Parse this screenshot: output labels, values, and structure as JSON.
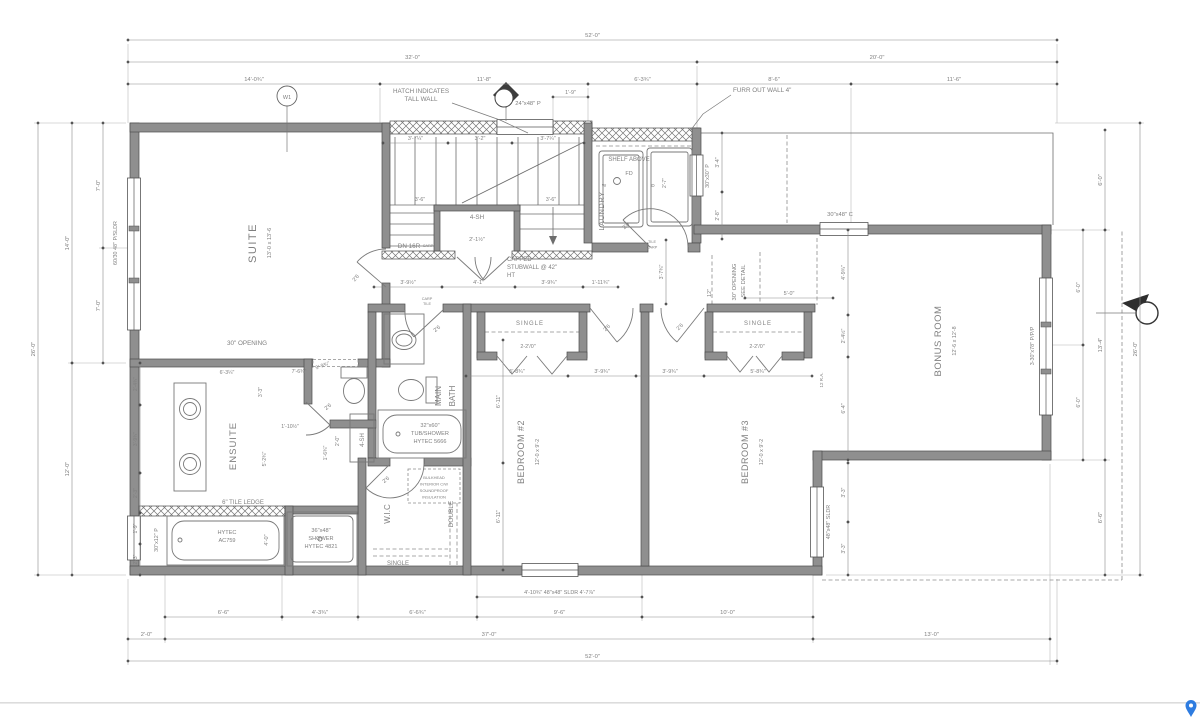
{
  "meta": {
    "description": "Residential floor plan drawing - suite, ensuite, main bath, laundry, bedrooms 2 and 3, bonus room"
  },
  "colors": {
    "wall_fill": "#8f8f8f",
    "line": "#6d6d6d",
    "text": "#7f7f7f",
    "pin_blue": "#2e7ce0"
  },
  "plan": {
    "labels": [
      {
        "n": "room-label-suite",
        "t": "SUITE",
        "x": 256,
        "y": 243,
        "r": -90,
        "s": 11,
        "ls": 1.5
      },
      {
        "n": "room-size-suite",
        "t": "13'-0 x 13'-6",
        "x": 271,
        "y": 243,
        "r": -90,
        "s": 5.6
      },
      {
        "n": "room-label-ensuite",
        "t": "ENSUITE",
        "x": 236,
        "y": 446,
        "r": -90,
        "s": 9.5,
        "ls": 1
      },
      {
        "n": "room-label-main-bath-1",
        "t": "MAIN",
        "x": 441,
        "y": 396,
        "r": -90,
        "s": 8
      },
      {
        "n": "room-label-main-bath-2",
        "t": "BATH",
        "x": 455,
        "y": 396,
        "r": -90,
        "s": 8
      },
      {
        "n": "room-label-wic",
        "t": "W.I.C",
        "x": 390,
        "y": 514,
        "r": -90,
        "s": 8
      },
      {
        "n": "room-label-bedroom2",
        "t": "BEDROOM #2",
        "x": 524,
        "y": 452,
        "r": -90,
        "s": 9,
        "ls": 0.5
      },
      {
        "n": "room-size-bedroom2",
        "t": "12'-0 x 9'-2",
        "x": 539,
        "y": 452,
        "r": -90,
        "s": 5.4
      },
      {
        "n": "room-label-bedroom3",
        "t": "BEDROOM #3",
        "x": 748,
        "y": 452,
        "r": -90,
        "s": 9,
        "ls": 0.5
      },
      {
        "n": "room-size-bedroom3",
        "t": "12'-0 x 9'-2",
        "x": 763,
        "y": 452,
        "r": -90,
        "s": 5.4
      },
      {
        "n": "room-label-bonus",
        "t": "BONUS ROOM",
        "x": 941,
        "y": 341,
        "r": -90,
        "s": 9.5,
        "ls": 0.5
      },
      {
        "n": "room-size-bonus",
        "t": "12'-6 x 12'-8",
        "x": 956,
        "y": 341,
        "r": -90,
        "s": 5.4
      },
      {
        "n": "room-label-laundry",
        "t": "LAUNDRY",
        "x": 604,
        "y": 211,
        "r": -90,
        "s": 7.5,
        "ls": 0.5
      },
      {
        "n": "closet-label-double",
        "t": "DOUBLE",
        "x": 453,
        "y": 514,
        "r": -90,
        "s": 6.5
      },
      {
        "n": "closet-label-single-wic",
        "t": "SINGLE",
        "x": 398,
        "y": 565,
        "s": 6
      },
      {
        "n": "closet-label-single-bed2",
        "t": "SINGLE",
        "x": 530,
        "y": 325,
        "s": 6,
        "ls": 1
      },
      {
        "n": "closet-label-single-bed3",
        "t": "SINGLE",
        "x": 758,
        "y": 325,
        "s": 6,
        "ls": 1
      },
      {
        "n": "note-hatch-1",
        "t": "HATCH INDICATES",
        "x": 421,
        "y": 93,
        "s": 6.3
      },
      {
        "n": "note-hatch-2",
        "t": "TALL WALL",
        "x": 421,
        "y": 101,
        "s": 6.3
      },
      {
        "n": "note-furr",
        "t": "FURR OUT WALL 4\"",
        "x": 733,
        "y": 92,
        "s": 6.3,
        "a": "start"
      },
      {
        "n": "note-shelf-above",
        "t": "SHELF ABOVE",
        "x": 629,
        "y": 161,
        "s": 6
      },
      {
        "n": "label-floor-drain",
        "t": "FD",
        "x": 629,
        "y": 175,
        "s": 5.5
      },
      {
        "n": "label-washer",
        "t": "W",
        "x": 604,
        "y": 187,
        "s": 4.5
      },
      {
        "n": "label-dryer",
        "t": "D",
        "x": 653,
        "y": 187,
        "s": 4.5
      },
      {
        "n": "note-capped-1",
        "t": "CAPPED",
        "x": 507,
        "y": 261,
        "s": 6,
        "a": "start"
      },
      {
        "n": "note-capped-2",
        "t": "STUBWALL @ 42\"",
        "x": 507,
        "y": 269,
        "s": 6,
        "a": "start"
      },
      {
        "n": "note-capped-3",
        "t": "HT",
        "x": 507,
        "y": 277,
        "s": 6,
        "a": "start"
      },
      {
        "n": "note-30-opening",
        "t": "30\" OPENING",
        "x": 247,
        "y": 345,
        "s": 6.3
      },
      {
        "n": "note-tile-ledge",
        "t": "6\" TILE LEDGE",
        "x": 243,
        "y": 504,
        "s": 6
      },
      {
        "n": "fixture-tub-label-1",
        "t": "HYTEC",
        "x": 227,
        "y": 534,
        "s": 5.6
      },
      {
        "n": "fixture-tub-label-2",
        "t": "AC759",
        "x": 227,
        "y": 542,
        "s": 5.6
      },
      {
        "n": "fixture-shower-label-1",
        "t": "36\"x48\"",
        "x": 321,
        "y": 532,
        "s": 5.6
      },
      {
        "n": "fixture-shower-label-2",
        "t": "SHOWER",
        "x": 321,
        "y": 540,
        "s": 5.6
      },
      {
        "n": "fixture-shower-label-3",
        "t": "HYTEC 4821",
        "x": 321,
        "y": 548,
        "s": 5.6
      },
      {
        "n": "fixture-tubshower-label-1",
        "t": "32\"x60\"",
        "x": 430,
        "y": 427,
        "s": 5.6
      },
      {
        "n": "fixture-tubshower-label-2",
        "t": "TUB/SHOWER",
        "x": 430,
        "y": 435,
        "s": 5.6
      },
      {
        "n": "fixture-tubshower-label-3",
        "t": "HYTEC 5666",
        "x": 430,
        "y": 443,
        "s": 5.6
      },
      {
        "n": "label-4sh-stair",
        "t": "4-SH",
        "x": 477,
        "y": 219,
        "s": 6.3
      },
      {
        "n": "dim-closet-depth",
        "t": "2'-1½\"",
        "x": 477,
        "y": 241,
        "s": 5.6
      },
      {
        "n": "label-4sh-ensuite",
        "t": "4-SH",
        "x": 364,
        "y": 440,
        "r": -90,
        "s": 6
      },
      {
        "n": "label-dn-16r",
        "t": "DN 16R",
        "x": 409,
        "y": 248,
        "s": 6.3
      },
      {
        "n": "note-bonus-opening-1",
        "t": "30\" OPENING",
        "x": 736,
        "y": 282,
        "r": -90,
        "s": 5.8
      },
      {
        "n": "note-bonus-opening-2",
        "t": "-SEE DETAIL",
        "x": 745,
        "y": 282,
        "r": -90,
        "s": 5.8
      },
      {
        "n": "window-label-suite",
        "t": "60/30 48\" P/SLDR",
        "x": 117,
        "y": 243,
        "r": -90,
        "s": 5.4
      },
      {
        "n": "window-label-tub",
        "t": "30\"x12\" P",
        "x": 158,
        "y": 540,
        "r": -90,
        "s": 5.4
      },
      {
        "n": "window-label-stair",
        "t": "24\"x48\" P",
        "x": 528,
        "y": 105,
        "s": 5.8
      },
      {
        "n": "window-label-laundry",
        "t": "30\"x30\" P",
        "x": 709,
        "y": 176,
        "r": -90,
        "s": 5.4
      },
      {
        "n": "window-label-bonus-top",
        "t": "30\"x48\" C",
        "x": 840,
        "y": 216,
        "s": 5.8
      },
      {
        "n": "window-label-bonus-right",
        "t": "3-30\"x78\" P/P/P",
        "x": 1034,
        "y": 346,
        "r": -90,
        "s": 5.4
      },
      {
        "n": "window-label-bed3",
        "t": "48\"x48\" SLDR",
        "x": 830,
        "y": 522,
        "r": -90,
        "s": 5.4
      },
      {
        "n": "keynote-w1-label",
        "t": "W1",
        "x": 287,
        "y": 99,
        "s": 5.5
      },
      {
        "n": "note-box-line-1",
        "t": "BULKHEAD",
        "x": 434,
        "y": 479,
        "s": 4
      },
      {
        "n": "note-box-line-2",
        "t": "INTERIOR C/W",
        "x": 434,
        "y": 485.5,
        "s": 4
      },
      {
        "n": "note-box-line-3",
        "t": "SOUNDPROOF",
        "x": 434,
        "y": 492,
        "s": 4
      },
      {
        "n": "note-box-line-4",
        "t": "INSULATION",
        "x": 434,
        "y": 498.5,
        "s": 4
      },
      {
        "n": "finish-tile-laundry",
        "t": "TILE",
        "x": 652,
        "y": 243,
        "s": 3.8
      },
      {
        "n": "finish-carp-laundry",
        "t": "CARP",
        "x": 652,
        "y": 248.5,
        "s": 3.8
      },
      {
        "n": "finish-carp-stair",
        "t": "CARP",
        "x": 428,
        "y": 247,
        "s": 3.8
      },
      {
        "n": "finish-carp-bath",
        "t": "CARP",
        "x": 427,
        "y": 300,
        "s": 3.8
      },
      {
        "n": "finish-tile-bath",
        "t": "TILE",
        "x": 427,
        "y": 305,
        "s": 3.8
      },
      {
        "n": "label-return-air",
        "t": "12 R.A.",
        "x": 823,
        "y": 380,
        "r": -90,
        "s": 4.5
      },
      {
        "n": "door-label-suite",
        "t": "2'6",
        "x": 357,
        "y": 279,
        "r": -50,
        "s": 5.4
      },
      {
        "n": "door-label-wc",
        "t": "2'6",
        "x": 329,
        "y": 408,
        "r": -40,
        "s": 5.4
      },
      {
        "n": "door-label-bath",
        "t": "2'6",
        "x": 438,
        "y": 330,
        "r": -40,
        "s": 5.4
      },
      {
        "n": "door-label-wic",
        "t": "2'6",
        "x": 387,
        "y": 481,
        "r": -40,
        "s": 5.4
      },
      {
        "n": "door-label-laundry",
        "t": "2'6",
        "x": 627,
        "y": 227,
        "r": -45,
        "s": 5.4
      },
      {
        "n": "door-label-bed2",
        "t": "2'6",
        "x": 608,
        "y": 329,
        "r": -45,
        "s": 5.4
      },
      {
        "n": "door-label-bed3",
        "t": "2'6",
        "x": 681,
        "y": 328,
        "r": -45,
        "s": 5.4
      },
      {
        "n": "dim-dryer-width",
        "t": "2'-7\"",
        "x": 666,
        "y": 183,
        "r": -90,
        "s": 5
      },
      {
        "n": "closet-doors-bed2",
        "t": "2-2'/0\"",
        "x": 528,
        "y": 348,
        "s": 5.4
      },
      {
        "n": "closet-doors-bed3",
        "t": "2-2'/0\"",
        "x": 757,
        "y": 348,
        "s": 5.4
      },
      {
        "n": "dim-stair-1",
        "t": "3'-6\"",
        "x": 420,
        "y": 201,
        "s": 5.2
      },
      {
        "n": "dim-stair-2",
        "t": "3'-6\"",
        "x": 551,
        "y": 201,
        "s": 5.2
      },
      {
        "n": "dim-ensuite-1",
        "t": "6'-3¼\"",
        "x": 227,
        "y": 374,
        "s": 5.2
      },
      {
        "n": "dim-ensuite-2",
        "t": "3'-3\"",
        "x": 262,
        "y": 392,
        "r": -90,
        "s": 5.2
      },
      {
        "n": "dim-ensuite-3",
        "t": "7'-6¾\"",
        "x": 299,
        "y": 373,
        "s": 5.2
      },
      {
        "n": "dim-ensuite-4",
        "t": "5'-9¾\"",
        "x": 323,
        "y": 367,
        "r": -20,
        "s": 5.2
      },
      {
        "n": "dim-ensuite-5",
        "t": "1'-10½\"",
        "x": 290,
        "y": 428,
        "s": 5.2
      },
      {
        "n": "dim-ensuite-6",
        "t": "5'-2¾\"",
        "x": 266,
        "y": 459,
        "r": -90,
        "s": 5.2
      },
      {
        "n": "dim-ensuite-7",
        "t": "2'-0\"",
        "x": 339,
        "y": 441,
        "r": -90,
        "s": 5.2
      },
      {
        "n": "dim-ensuite-8",
        "t": "1'-6¾\"",
        "x": 327,
        "y": 453,
        "r": -90,
        "s": 5.2
      },
      {
        "n": "dim-tub-length",
        "t": "4'-0\"",
        "x": 268,
        "y": 540,
        "r": -90,
        "s": 5.6
      },
      {
        "n": "dim-opening-12",
        "t": "12\"",
        "x": 711,
        "y": 293,
        "r": -90,
        "s": 5.2
      }
    ],
    "dims": [
      {
        "t": "52'-0\"",
        "x1": 128,
        "y1": 40,
        "x2": 1057,
        "y2": 40
      },
      {
        "t": "32'-0\"",
        "x1": 128,
        "y1": 62,
        "x2": 697,
        "y2": 62
      },
      {
        "t": "20'-0\"",
        "x1": 697,
        "y1": 62,
        "x2": 1057,
        "y2": 62
      },
      {
        "t": "14'-0¾\"",
        "x1": 128,
        "y1": 84,
        "x2": 380,
        "y2": 84
      },
      {
        "t": "11'-8\"",
        "x1": 380,
        "y1": 84,
        "x2": 588,
        "y2": 84
      },
      {
        "t": "6'-3¾\"",
        "x1": 588,
        "y1": 84,
        "x2": 697,
        "y2": 84
      },
      {
        "t": "8'-6\"",
        "x1": 697,
        "y1": 84,
        "x2": 851,
        "y2": 84
      },
      {
        "t": "11'-6\"",
        "x1": 851,
        "y1": 84,
        "x2": 1057,
        "y2": 84
      },
      {
        "t": "1'-9\"",
        "x1": 553,
        "y1": 97,
        "x2": 588,
        "y2": 97,
        "s": 5.4
      },
      {
        "t": "3'-7¼\"",
        "x1": 383,
        "y1": 143,
        "x2": 448,
        "y2": 143,
        "s": 5.4
      },
      {
        "t": "3'-2\"",
        "x1": 448,
        "y1": 143,
        "x2": 512,
        "y2": 143,
        "s": 5.4
      },
      {
        "t": "3'-7¼\"",
        "x1": 512,
        "y1": 143,
        "x2": 584,
        "y2": 143,
        "s": 5.4
      },
      {
        "t": "6'-6\"",
        "x1": 165,
        "y1": 617,
        "x2": 282,
        "y2": 617
      },
      {
        "t": "4'-3¾\"",
        "x1": 282,
        "y1": 617,
        "x2": 358,
        "y2": 617
      },
      {
        "t": "6'-6¾\"",
        "x1": 358,
        "y1": 617,
        "x2": 477,
        "y2": 617
      },
      {
        "t": "9'-6\"",
        "x1": 477,
        "y1": 617,
        "x2": 642,
        "y2": 617
      },
      {
        "t": "10'-0\"",
        "x1": 642,
        "y1": 617,
        "x2": 813,
        "y2": 617
      },
      {
        "t": "4'-10¾\" 48\"x48\" SLDR 4'-7⅞\"",
        "x1": 477,
        "y1": 597,
        "x2": 642,
        "y2": 597,
        "s": 5.4
      },
      {
        "t": "2'-0\"",
        "x1": 128,
        "y1": 639,
        "x2": 165,
        "y2": 639
      },
      {
        "t": "37'-0\"",
        "x1": 165,
        "y1": 639,
        "x2": 813,
        "y2": 639
      },
      {
        "t": "13'-0\"",
        "x1": 813,
        "y1": 639,
        "x2": 1050,
        "y2": 639
      },
      {
        "t": "52'-0\"",
        "x1": 128,
        "y1": 661,
        "x2": 1057,
        "y2": 661
      },
      {
        "t": "26'-0\"",
        "x1": 38,
        "y1": 575,
        "x2": 38,
        "y2": 123
      },
      {
        "t": "14'-0\"",
        "x1": 72,
        "y1": 363,
        "x2": 72,
        "y2": 123
      },
      {
        "t": "12'-0\"",
        "x1": 72,
        "y1": 575,
        "x2": 72,
        "y2": 363
      },
      {
        "t": "7'-0\"",
        "x1": 103,
        "y1": 248,
        "x2": 103,
        "y2": 123
      },
      {
        "t": "7'-0\"",
        "x1": 103,
        "y1": 363,
        "x2": 103,
        "y2": 248
      },
      {
        "t": "2'-4¾\"",
        "x1": 140,
        "y1": 405,
        "x2": 140,
        "y2": 363,
        "s": 5
      },
      {
        "t": "3'-9¾\"",
        "x1": 140,
        "y1": 473,
        "x2": 140,
        "y2": 405,
        "s": 5
      },
      {
        "t": "2'-3\"",
        "x1": 140,
        "y1": 513,
        "x2": 140,
        "y2": 473,
        "s": 5
      },
      {
        "t": "1'-9\"",
        "x1": 140,
        "y1": 544,
        "x2": 140,
        "y2": 513,
        "s": 5
      },
      {
        "t": "2'-3\"",
        "x1": 140,
        "y1": 575,
        "x2": 140,
        "y2": 544,
        "s": 5
      },
      {
        "t": "26'-0\"",
        "x1": 1140,
        "y1": 575,
        "x2": 1140,
        "y2": 123
      },
      {
        "t": "6'-0\"",
        "x1": 1105,
        "y1": 230,
        "x2": 1105,
        "y2": 130
      },
      {
        "t": "13'-4\"",
        "x1": 1105,
        "y1": 460,
        "x2": 1105,
        "y2": 230
      },
      {
        "t": "6'-6\"",
        "x1": 1105,
        "y1": 575,
        "x2": 1105,
        "y2": 460
      },
      {
        "t": "6'-0\"",
        "x1": 1083,
        "y1": 345,
        "x2": 1083,
        "y2": 230,
        "s": 5.2
      },
      {
        "t": "6'-0\"",
        "x1": 1083,
        "y1": 460,
        "x2": 1083,
        "y2": 345,
        "s": 5.2
      },
      {
        "t": "3'-4\"",
        "x1": 722,
        "y1": 192,
        "x2": 722,
        "y2": 133,
        "s": 5.2
      },
      {
        "t": "2'-8\"",
        "x1": 722,
        "y1": 239,
        "x2": 722,
        "y2": 192,
        "s": 5.2
      },
      {
        "t": "4'-9¾\"",
        "x1": 848,
        "y1": 315,
        "x2": 848,
        "y2": 230,
        "s": 5.2
      },
      {
        "t": "2'-4½\"",
        "x1": 848,
        "y1": 357,
        "x2": 848,
        "y2": 315,
        "s": 5.2
      },
      {
        "t": "6'-4\"",
        "x1": 848,
        "y1": 460,
        "x2": 848,
        "y2": 357,
        "s": 5.2
      },
      {
        "t": "3'-3\"",
        "x1": 848,
        "y1": 522,
        "x2": 848,
        "y2": 463,
        "s": 5
      },
      {
        "t": "3'-3\"",
        "x1": 848,
        "y1": 575,
        "x2": 848,
        "y2": 522,
        "s": 5
      },
      {
        "t": "5'-0\"",
        "x1": 745,
        "y1": 298,
        "x2": 833,
        "y2": 298,
        "s": 5.4
      },
      {
        "t": "3'-7¾\"",
        "x1": 666,
        "y1": 304,
        "x2": 666,
        "y2": 240,
        "s": 5.2
      },
      {
        "t": "3'-9½\"",
        "x1": 374,
        "y1": 287,
        "x2": 442,
        "y2": 287,
        "s": 5.4
      },
      {
        "t": "4'-1\"",
        "x1": 442,
        "y1": 287,
        "x2": 515,
        "y2": 287,
        "s": 5.4
      },
      {
        "t": "3'-9¾\"",
        "x1": 515,
        "y1": 287,
        "x2": 583,
        "y2": 287,
        "s": 5.4
      },
      {
        "t": "1'-11¾\"",
        "x1": 583,
        "y1": 287,
        "x2": 618,
        "y2": 287,
        "s": 5.4
      },
      {
        "t": "5'-8¾\"",
        "x1": 466,
        "y1": 376,
        "x2": 568,
        "y2": 376,
        "s": 5.4
      },
      {
        "t": "3'-9¾\"",
        "x1": 568,
        "y1": 376,
        "x2": 636,
        "y2": 376,
        "s": 5.4
      },
      {
        "t": "3'-9¾\"",
        "x1": 636,
        "y1": 376,
        "x2": 704,
        "y2": 376,
        "s": 5.4
      },
      {
        "t": "5'-8¾\"",
        "x1": 704,
        "y1": 376,
        "x2": 812,
        "y2": 376,
        "s": 5.4
      },
      {
        "t": "6'-11\"",
        "x1": 503,
        "y1": 463,
        "x2": 503,
        "y2": 340,
        "s": 5.4
      },
      {
        "t": "6'-11\"",
        "x1": 503,
        "y1": 570,
        "x2": 503,
        "y2": 463,
        "s": 5.4
      }
    ]
  }
}
